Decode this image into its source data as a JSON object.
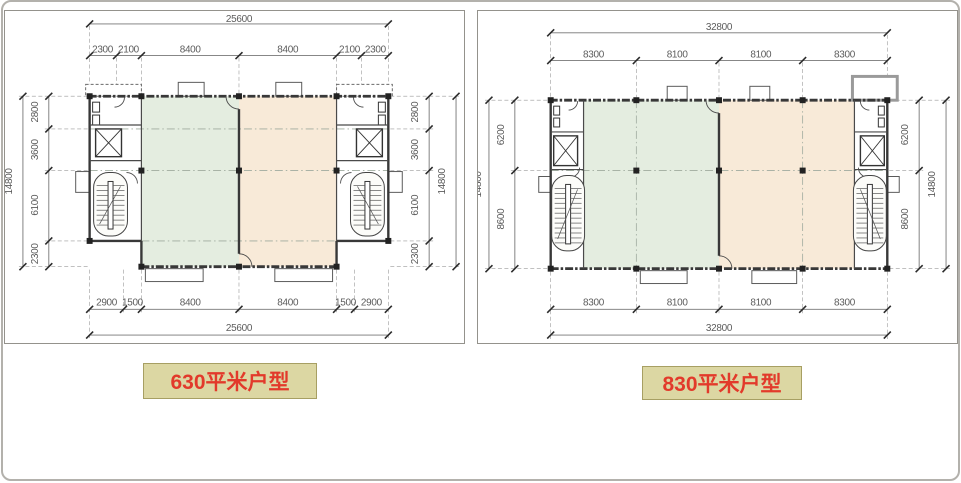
{
  "plans": [
    {
      "id": "plan-630",
      "label": "630平米户型",
      "dims": {
        "top_total": "25600",
        "top_segments": [
          "2300",
          "2100",
          "8400",
          "8400",
          "2100",
          "2300"
        ],
        "bottom_segments": [
          "2900",
          "1500",
          "8400",
          "8400",
          "1500",
          "2900"
        ],
        "bottom_total": "25600",
        "side_total": "14800",
        "side_segments": [
          "2800",
          "3600",
          "6100",
          "2300"
        ]
      }
    },
    {
      "id": "plan-830",
      "label": "830平米户型",
      "dims": {
        "top_total": "32800",
        "top_segments": [
          "8300",
          "8100",
          "8100",
          "8300"
        ],
        "bottom_segments": [
          "8300",
          "8100",
          "8100",
          "8300"
        ],
        "bottom_total": "32800",
        "side_total": "14800",
        "side_segments": [
          "6200",
          "8600"
        ]
      }
    }
  ],
  "colors": {
    "room_green": "#e4ede0",
    "room_peach": "#f8ead8",
    "label_bg": "#dcd7a3",
    "label_border": "#a79f63",
    "label_text": "#e23a2b",
    "dim_text": "#5c5c5c",
    "wall": "#383838"
  }
}
